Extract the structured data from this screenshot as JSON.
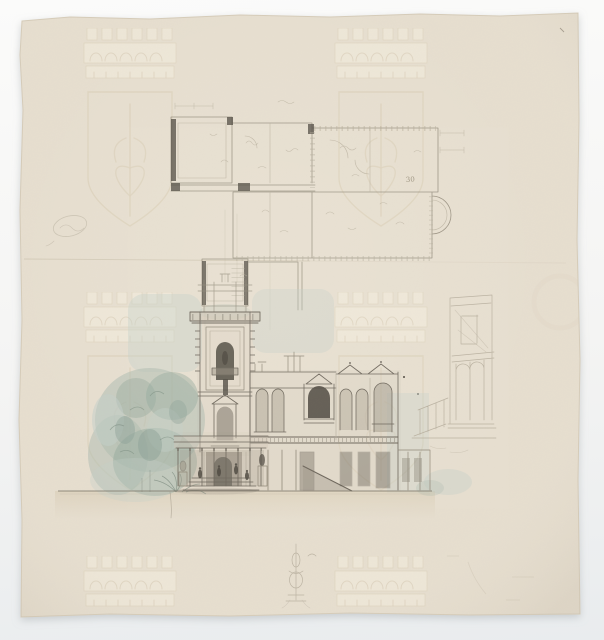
{
  "artwork": {
    "description": "Scan of a 19th-century architect's sheet: graphite floor-plan study at top, watercolour-tinted elevation of an Italianate villa with tall belvedere tower at centre, faint perspective study of the tower at right, small ornament doodle at bottom centre, on cream paper with a repeated crown-and-shield watermark.",
    "annotation": "30",
    "watermark": "mural crown above a shield enclosing a pierced heart, tiled across the sheet"
  },
  "colors": {
    "backdrop_top": "#fbfbfa",
    "backdrop_bottom": "#e9ecee",
    "paper": "#e7dfd0",
    "paper_edge": "#d6ccb9",
    "watermark_light": "#f3edde",
    "watermark_line": "#d7cbb1",
    "graphite": "#6b6459",
    "graphite_light": "#8f8777",
    "graphite_faint": "#b5ac9a",
    "dark_accent": "#4b463d",
    "wash_buff": "#dacfc0",
    "wash_tan": "#d9cdb4",
    "wash_green": "#aebcb0",
    "wash_green_dark": "#93a89c",
    "wash_blue": "#c3cfc9",
    "shadow_wash": "#a49d8f",
    "sketch_faint": "#b3aa99"
  }
}
